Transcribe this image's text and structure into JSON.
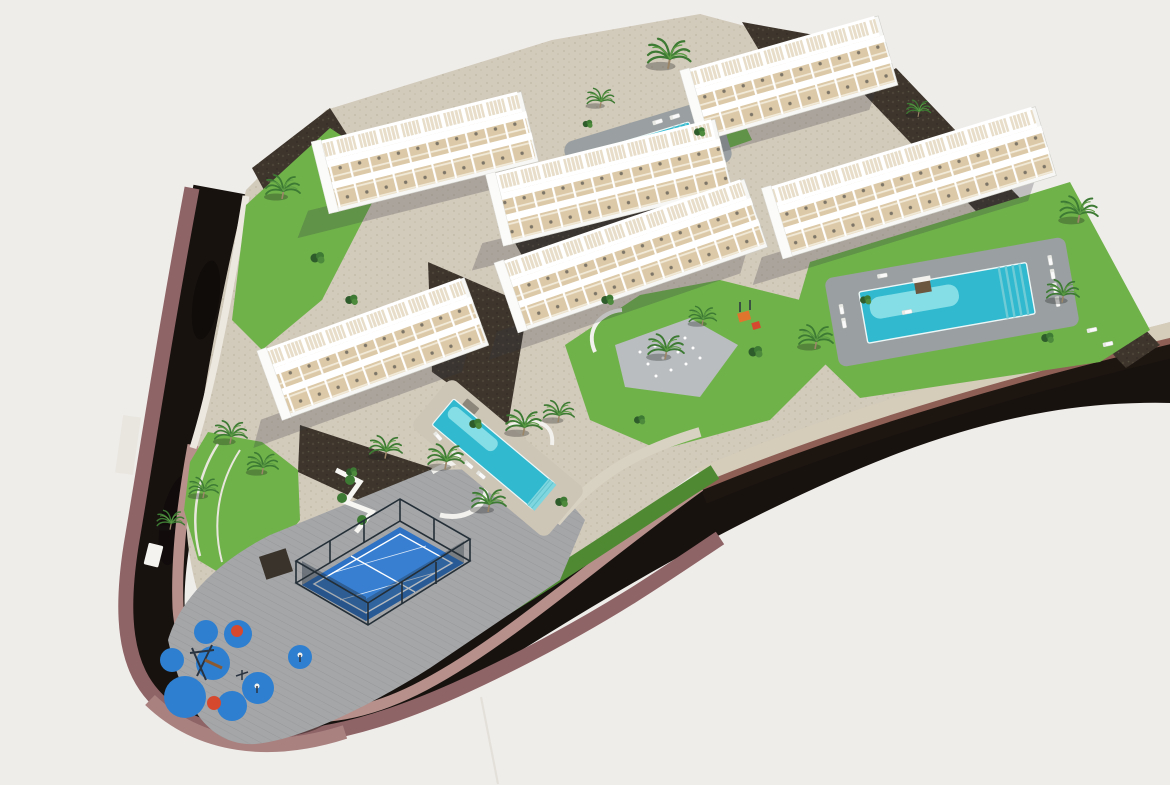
{
  "meta": {
    "description": "Aerial 3D architectural rendering of a terraced white apartment complex with three swimming pools, a padel court, a children's playground, palm trees and a dark curving access road on a light grey background"
  },
  "palette": {
    "background": "#efedea",
    "road_asphalt": "#18120f",
    "sidewalk_outer": "#8f6467",
    "sidewalk_outer_light": "#a98280",
    "sidewalk_inner": "#b7908b",
    "curb_stone": "#d5ccba",
    "curb_maroon": "#8d5f55",
    "platform_edge_dark": "#1d1510",
    "wall_white": "#ece8e0",
    "grass_dark": "#4f8a33",
    "grass_light": "#6fb24a",
    "pool_water": "#30b9cf",
    "pool_water_light": "#a9ecef",
    "pool_deck": "#9aa0a1",
    "stone_deck": "#cdc5b6",
    "padel_court": "#2d72c4",
    "padel_line": "#ffffff",
    "padel_cage": "#232e36",
    "playground_mat": "#2e7fd0",
    "playground_accent": "#d7492f",
    "building_wall": "#f7f7f5",
    "terrace_floor": "#dcc9a7",
    "rock": "#3e362d",
    "palm_frond": "#3d7a33",
    "palm_trunk": "#9b8668"
  },
  "scene": {
    "objects": [
      {
        "id": "road",
        "label": "curved access road with maroon sidewalks"
      },
      {
        "id": "building-north",
        "label": "apartment block north"
      },
      {
        "id": "building-northwest-back",
        "label": "apartment block north-west back row"
      },
      {
        "id": "building-northwest-front",
        "label": "apartment block north-west front row"
      },
      {
        "id": "building-east",
        "label": "apartment block east"
      },
      {
        "id": "building-central",
        "label": "apartment block central"
      },
      {
        "id": "building-southwest",
        "label": "apartment block south-west"
      },
      {
        "id": "pool-north",
        "label": "swimming pool north"
      },
      {
        "id": "pool-east",
        "label": "swimming pool east"
      },
      {
        "id": "pool-central",
        "label": "swimming pool central"
      },
      {
        "id": "padel-court",
        "label": "fenced padel court"
      },
      {
        "id": "playground",
        "label": "children playground with blue safety mats"
      },
      {
        "id": "splash-pad",
        "label": "splash fountain plaza"
      },
      {
        "id": "palm-trees",
        "label": "palm trees",
        "count": 18
      }
    ]
  }
}
